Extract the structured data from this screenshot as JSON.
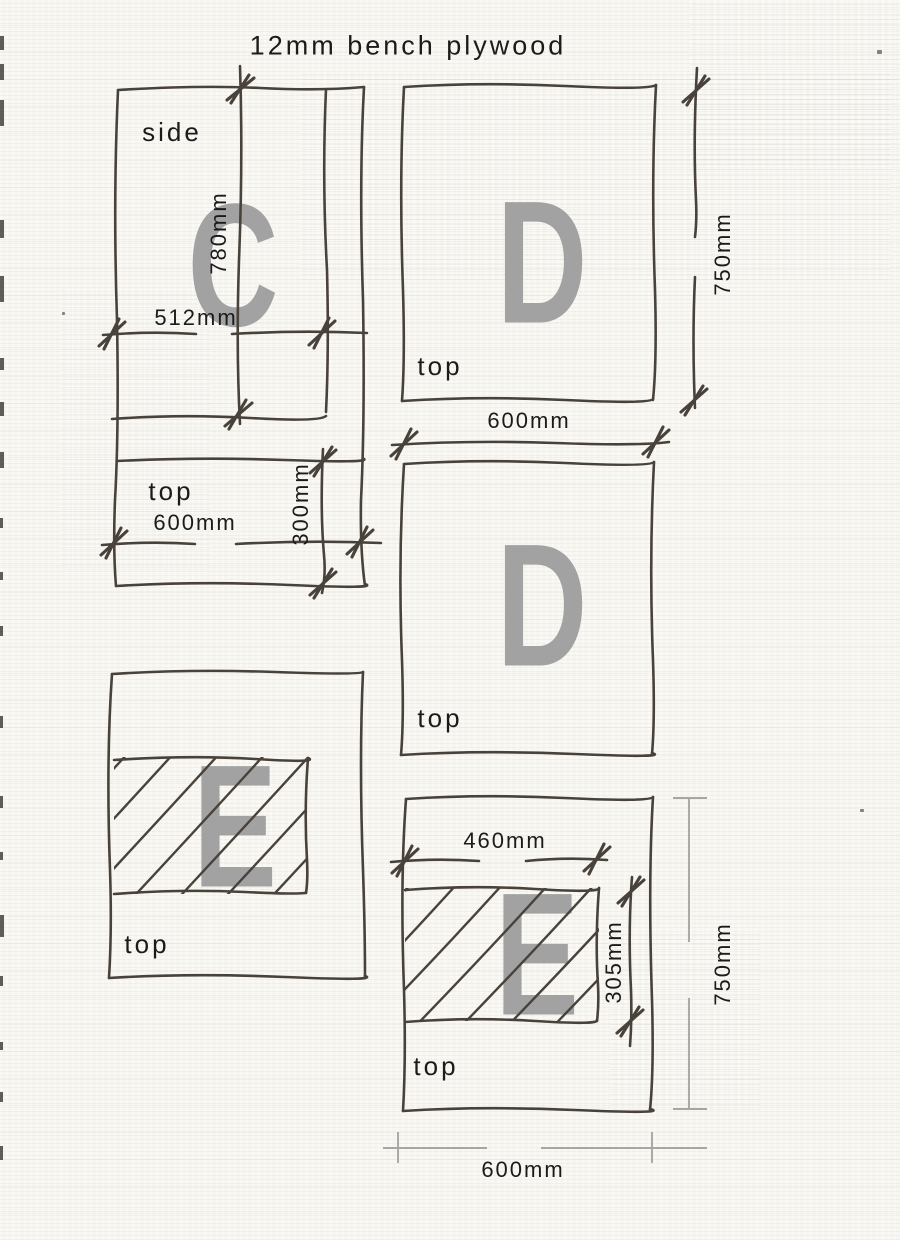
{
  "title": "12mm bench plywood",
  "panels": {
    "c_side": {
      "letter": "C",
      "view_label": "side",
      "dim_height": "780mm",
      "dim_width": "512mm"
    },
    "c_top": {
      "view_label": "top",
      "dim_width": "600mm",
      "dim_depth": "300mm"
    },
    "d_top": {
      "letter": "D",
      "view_label": "top",
      "dim_height": "750mm",
      "dim_width": "600mm"
    },
    "d_mid": {
      "letter": "D",
      "view_label": "top"
    },
    "e_left": {
      "letter": "E",
      "view_label": "top"
    },
    "e_right": {
      "letter": "E",
      "view_label": "top",
      "dim_cut_width": "460mm",
      "dim_cut_height": "305mm",
      "dim_height": "750mm",
      "dim_width": "600mm"
    }
  },
  "colors": {
    "ink": "#49423b",
    "letter_gray": "#a2a2a2",
    "cad_gray": "#a6a6a2",
    "label": "#1b1b1b",
    "paper": "#f7f6f1"
  }
}
